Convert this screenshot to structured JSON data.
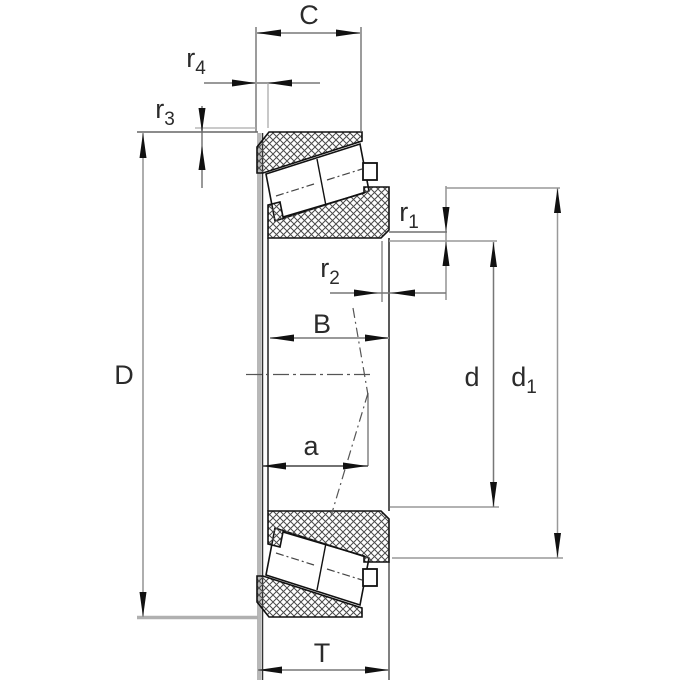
{
  "drawing": {
    "labels": {
      "C": "C",
      "r4": {
        "base": "r",
        "sub": "4"
      },
      "r3": {
        "base": "r",
        "sub": "3"
      },
      "D": "D",
      "r1": {
        "base": "r",
        "sub": "1"
      },
      "r2": {
        "base": "r",
        "sub": "2"
      },
      "B": "B",
      "a": "a",
      "d": "d",
      "d1": {
        "base": "d",
        "sub": "1"
      },
      "T": "T"
    },
    "colors": {
      "background": "#ffffff",
      "outline": "#111111",
      "hatch": "#4a4a4a",
      "dimension_line": "#999999",
      "extension_line": "#666666",
      "thick_gray_edge": "#b8b8b8",
      "arrow": "#111111",
      "label": "#2b2b2b",
      "centerline": "#555555"
    }
  }
}
